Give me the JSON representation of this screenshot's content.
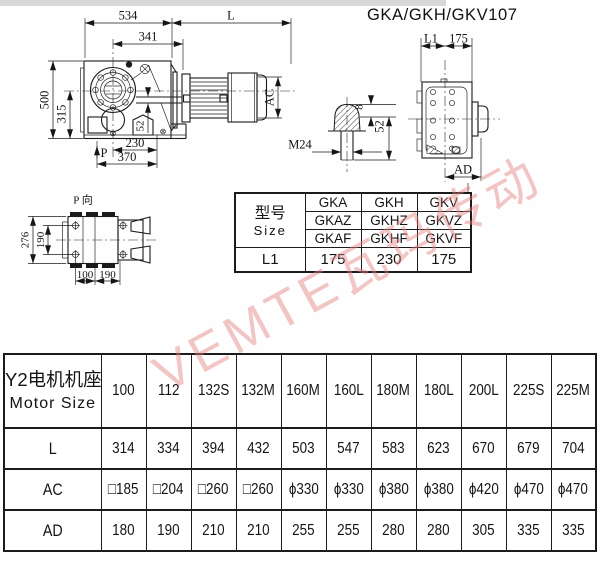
{
  "page": {
    "title": "GKA/GKH/GKV107",
    "watermark": "VEMTE瓦玛传动"
  },
  "side_view": {
    "dim_534": "534",
    "dim_L": "L",
    "dim_341": "341",
    "dim_500": "500",
    "dim_315": "315",
    "dim_52": "52",
    "dim_230": "230",
    "dim_370": "370",
    "dim_P": "P",
    "dim_AC": "AC"
  },
  "end_view": {
    "dim_L1": "L1",
    "dim_175": "175",
    "dim_AD": "AD"
  },
  "shaft_detail": {
    "dim_8": "8",
    "dim_52": "52",
    "dim_M24": "M24"
  },
  "p_view": {
    "label": "P 向",
    "dim_276": "276",
    "dim_190_v": "190",
    "dim_100": "100",
    "dim_190_h": "190"
  },
  "size_table": {
    "header_cn": "型号",
    "header_en": "Size",
    "model_rows": [
      [
        "GKA",
        "GKH",
        "GKV"
      ],
      [
        "GKAZ",
        "GKHZ",
        "GKVZ"
      ],
      [
        "GKAF",
        "GKHF",
        "GKVF"
      ]
    ],
    "l1_label": "L1",
    "l1_values": [
      "175",
      "230",
      "175"
    ]
  },
  "motor_table": {
    "header_cn": "Y2电机机座号",
    "header_en": "Motor Size",
    "columns": [
      "100",
      "112",
      "132S",
      "132M",
      "160M",
      "160L",
      "180M",
      "180L",
      "200L",
      "225S",
      "225M"
    ],
    "rows": [
      {
        "label": "L",
        "values": [
          "314",
          "334",
          "394",
          "432",
          "503",
          "547",
          "583",
          "623",
          "670",
          "679",
          "704"
        ]
      },
      {
        "label": "AC",
        "values": [
          "□185",
          "□204",
          "□260",
          "□260",
          "ϕ330",
          "ϕ330",
          "ϕ380",
          "ϕ380",
          "ϕ420",
          "ϕ470",
          "ϕ470"
        ]
      },
      {
        "label": "AD",
        "values": [
          "180",
          "190",
          "210",
          "210",
          "255",
          "255",
          "280",
          "280",
          "305",
          "335",
          "335"
        ]
      }
    ]
  }
}
